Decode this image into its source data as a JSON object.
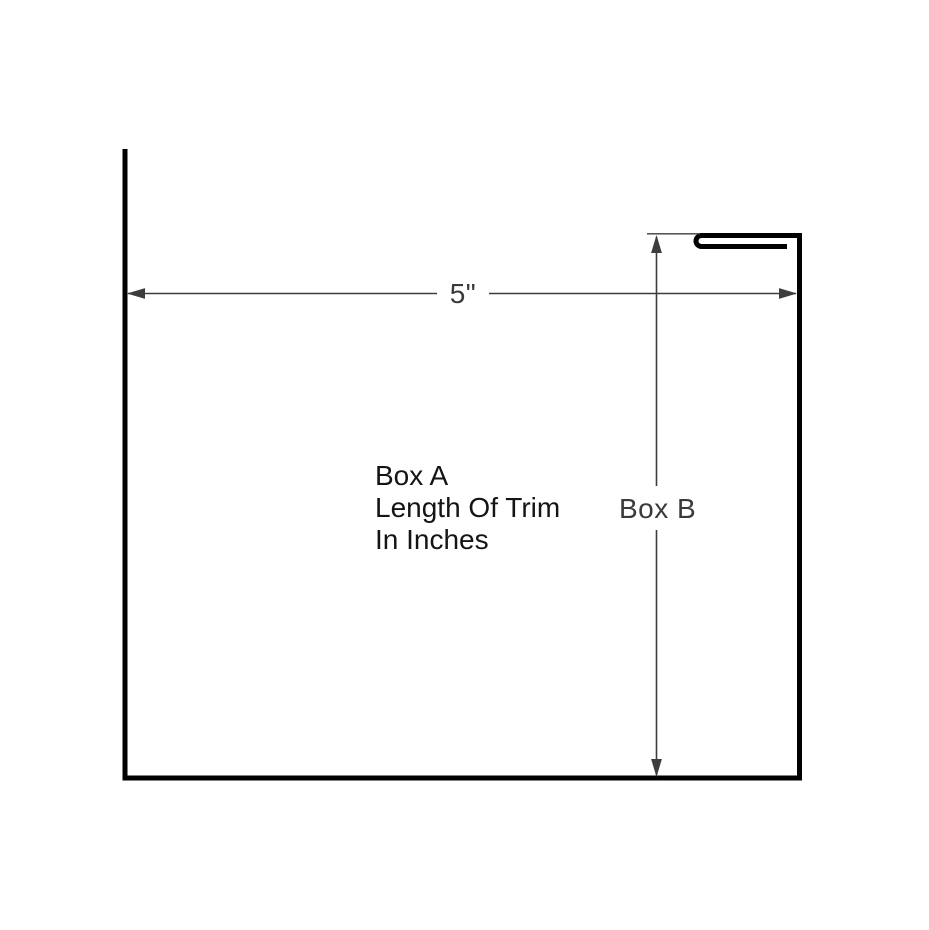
{
  "diagram": {
    "type": "trim-profile-dimension-drawing",
    "labels": {
      "width_dimension": "5\"",
      "box_a_line1": "Box A",
      "box_a_line2": "Length Of Trim",
      "box_a_line3": "In Inches",
      "box_b": "Box B"
    },
    "dimensions": {
      "width_value": "5\"",
      "height_reference": "Box B",
      "length_reference": "Box A (Length Of Trim In Inches)"
    },
    "colors": {
      "background": "#ffffff",
      "profile_stroke": "#000000",
      "dimension_stroke": "#3d3d3d",
      "dimension_text": "#3a3a3a",
      "note_text": "#141414"
    }
  }
}
